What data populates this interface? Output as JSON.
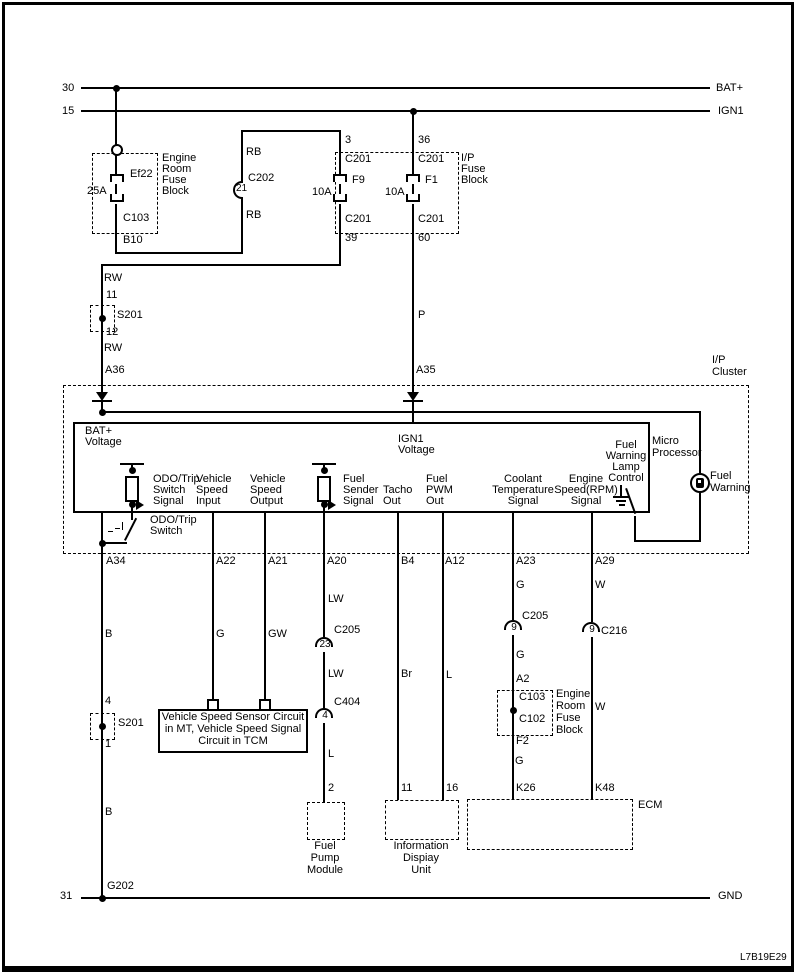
{
  "code": "L7B19E29",
  "power_rails": {
    "rail30": "30",
    "bat": "BAT+",
    "rail15": "15",
    "ign1": "IGN1",
    "rail31": "31",
    "gnd": "GND"
  },
  "erfb_top": {
    "name": [
      "Engine",
      "Room",
      "Fuse",
      "Block"
    ],
    "fuse": "Ef22",
    "rating": "25A",
    "connector": "C103",
    "pin": "B10"
  },
  "ipfb": {
    "name": [
      "I/P",
      "Fuse",
      "Block"
    ],
    "f9": {
      "pin_top": "3",
      "conn_top": "C201",
      "name": "F9",
      "rating": "10A",
      "conn_bot": "C201",
      "pin_bot": "39"
    },
    "f1": {
      "pin_top": "36",
      "conn_top": "C201",
      "name": "F1",
      "rating": "10A",
      "conn_bot": "C201",
      "pin_bot": "60"
    }
  },
  "conn": {
    "c202": {
      "name": "C202",
      "pin": "21"
    },
    "s201a": {
      "name": "S201",
      "pin_top": "11",
      "pin_bot": "12"
    },
    "s201b": {
      "name": "S201",
      "pin_top": "4",
      "pin_bot": "1"
    },
    "c205a": {
      "name": "C205",
      "pin": "23"
    },
    "c404": {
      "name": "C404",
      "pin": "4"
    },
    "c205b": {
      "name": "C205",
      "pin": "9"
    },
    "c216": {
      "name": "C216",
      "pin": "9"
    }
  },
  "wires": {
    "rb1": "RB",
    "rb2": "RB",
    "rw1": "RW",
    "rw2": "RW",
    "p": "P",
    "b1": "B",
    "b2": "B",
    "g1": "G",
    "gw": "GW",
    "lw1": "LW",
    "lw2": "LW",
    "l1": "L",
    "br": "Br",
    "l2": "L",
    "g2": "G",
    "g3": "G",
    "g4": "G",
    "w1": "W",
    "w2": "W"
  },
  "cluster": {
    "name": [
      "I/P",
      "Cluster"
    ],
    "a36": "A36",
    "a35": "A35",
    "bat": [
      "BAT+",
      "Voltage"
    ],
    "ign": [
      "IGN1",
      "Voltage"
    ],
    "sig": {
      "odo": [
        "ODO/Trip",
        "Switch",
        "Signal"
      ],
      "vsi": [
        "Vehicle",
        "Speed",
        "Input"
      ],
      "vso": [
        "Vehicle",
        "Speed",
        "Output"
      ],
      "fss": [
        "Fuel",
        "Sender",
        "Signal"
      ],
      "tacho": [
        "Tacho",
        "Out"
      ],
      "fpwm": [
        "Fuel",
        "PWM",
        "Out"
      ],
      "cts": [
        "Coolant",
        "Temperature",
        "Signal"
      ],
      "ess": [
        "Engine",
        "Speed(RPM)",
        "Signal"
      ],
      "fwlc": [
        "Fuel",
        "Warning",
        "Lamp",
        "Control"
      ]
    },
    "micro": [
      "Micro",
      "Processor"
    ],
    "fw": [
      "Fuel",
      "Warning"
    ],
    "odosw": [
      "ODO/Trip",
      "Switch"
    ],
    "pins": {
      "a34": "A34",
      "a22": "A22",
      "a21": "A21",
      "a20": "A20",
      "b4": "B4",
      "a12": "A12",
      "a23": "A23",
      "a29": "A29"
    }
  },
  "erfb_bot": {
    "name": [
      "Engine",
      "Room",
      "Fuse",
      "Block"
    ],
    "pin_in": "A2",
    "c_top": "C103",
    "c_bot": "C102",
    "fuse": "F2"
  },
  "dest": {
    "vss": [
      "Vehicle Speed Sensor Circuit",
      "in MT, Vehicle Speed Signal",
      "Circuit in TCM"
    ],
    "fpm": {
      "pin": "2",
      "name": [
        "Fuel",
        "Pump",
        "Module"
      ]
    },
    "idu": {
      "p1": "11",
      "p2": "16",
      "name": [
        "Information",
        "Dispiay",
        "Unit"
      ]
    },
    "ecm": {
      "p1": "K26",
      "p2": "K48",
      "name": "ECM"
    },
    "g202": "G202"
  }
}
